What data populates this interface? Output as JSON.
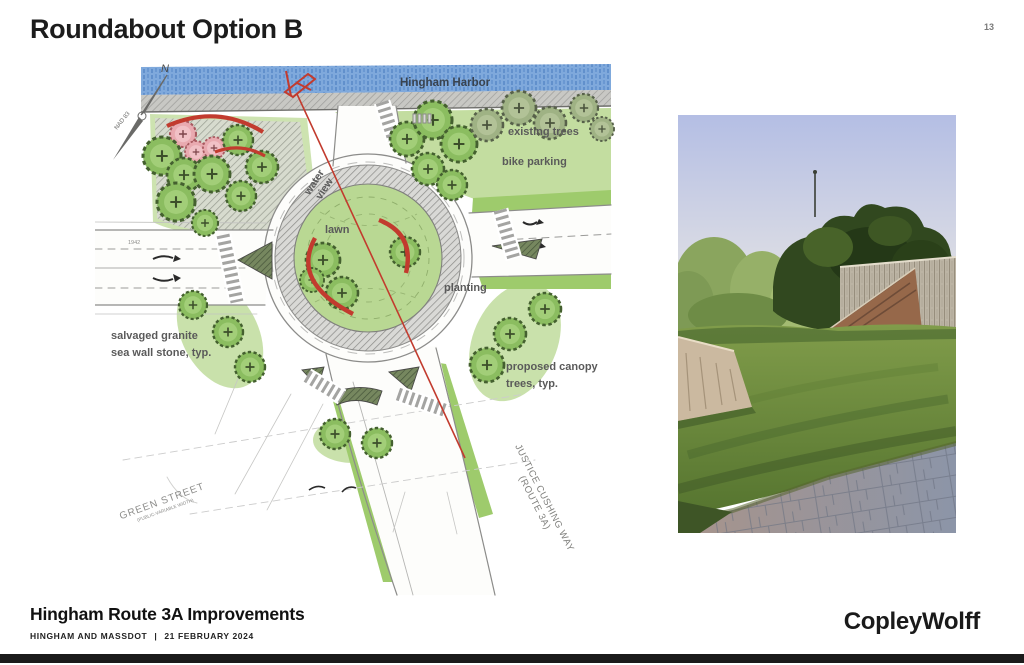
{
  "header": {
    "title": "Roundabout Option B",
    "page_number": "13"
  },
  "plan": {
    "harbor_label": "Hingham Harbor",
    "north_label": "N",
    "datum_label": "NAD 83",
    "year_mark": "1942",
    "labels": {
      "existing_trees": "existing trees",
      "bike_parking": "bike parking",
      "water_view_1": "water",
      "water_view_2": "view",
      "lawn": "lawn",
      "planting": "planting",
      "granite_line1": "salvaged granite",
      "granite_line2": "sea wall stone, typ.",
      "canopy_line1": "proposed canopy",
      "canopy_line2": "trees, typ.",
      "green_street": "GREEN STREET",
      "green_street_sub": "(PUBLIC-VARIABLE WIDTH)",
      "justice_line1": "JUSTICE CUSHING WAY",
      "justice_line2": "(ROUTE 3A)"
    }
  },
  "footer": {
    "project_title": "Hingham Route 3A Improvements",
    "client_line": {
      "agency": "HINGHAM AND MASSDOT",
      "divider": "|",
      "date": "21 FEBRUARY 2024"
    },
    "logo_text": "CopleyWolff"
  },
  "colors": {
    "accent_red": "#c23b2e",
    "water_blue": "#7fa9dc",
    "tree_green": "#8bbd60",
    "lawn_green": "#b9d893",
    "label_gray": "#5f5f5f",
    "bar_black": "#1b1b1b"
  }
}
